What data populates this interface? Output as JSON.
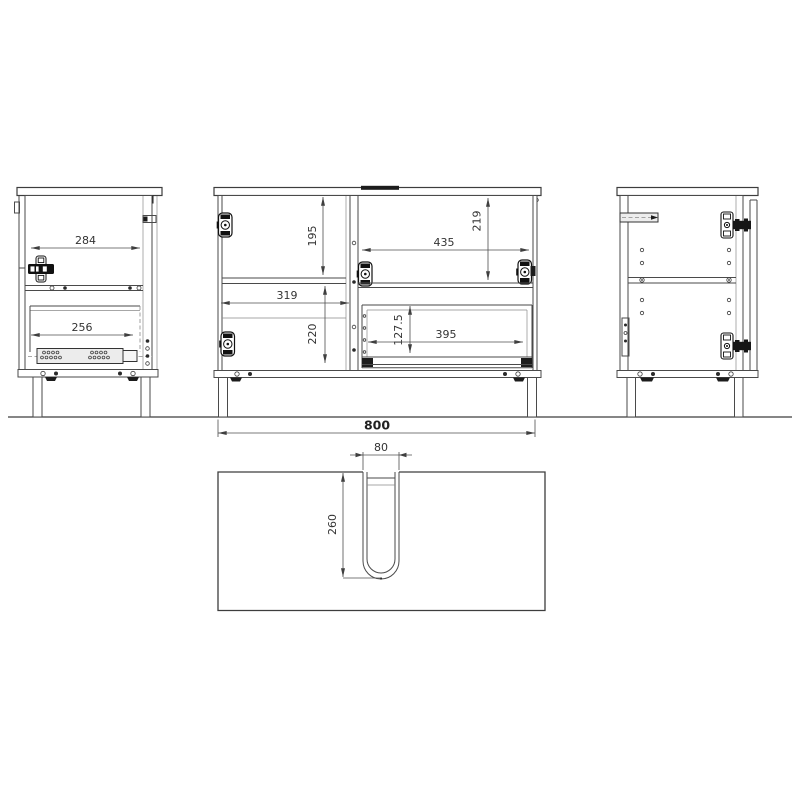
{
  "background": "#ffffff",
  "line_color": "#4a4a4a",
  "text_color": "#333333",
  "views": {
    "left_side": {
      "label": "left side view",
      "dims": {
        "top_inner_width": "284",
        "drawer_slide_width": "256"
      }
    },
    "front": {
      "label": "front view",
      "dims": {
        "upper_compartment_height": "195",
        "left_inner_width": "319",
        "lower_compartment_height": "220",
        "right_upper_height": "219",
        "right_inner_width": "435",
        "drawer_front_height": "127.5",
        "drawer_inner_width": "395"
      }
    },
    "right_side": {
      "label": "right side view"
    },
    "top_panel": {
      "label": "top panel view",
      "dims": {
        "cutout_width": "80",
        "cutout_depth": "260"
      }
    },
    "overall": {
      "total_width": "800"
    }
  }
}
